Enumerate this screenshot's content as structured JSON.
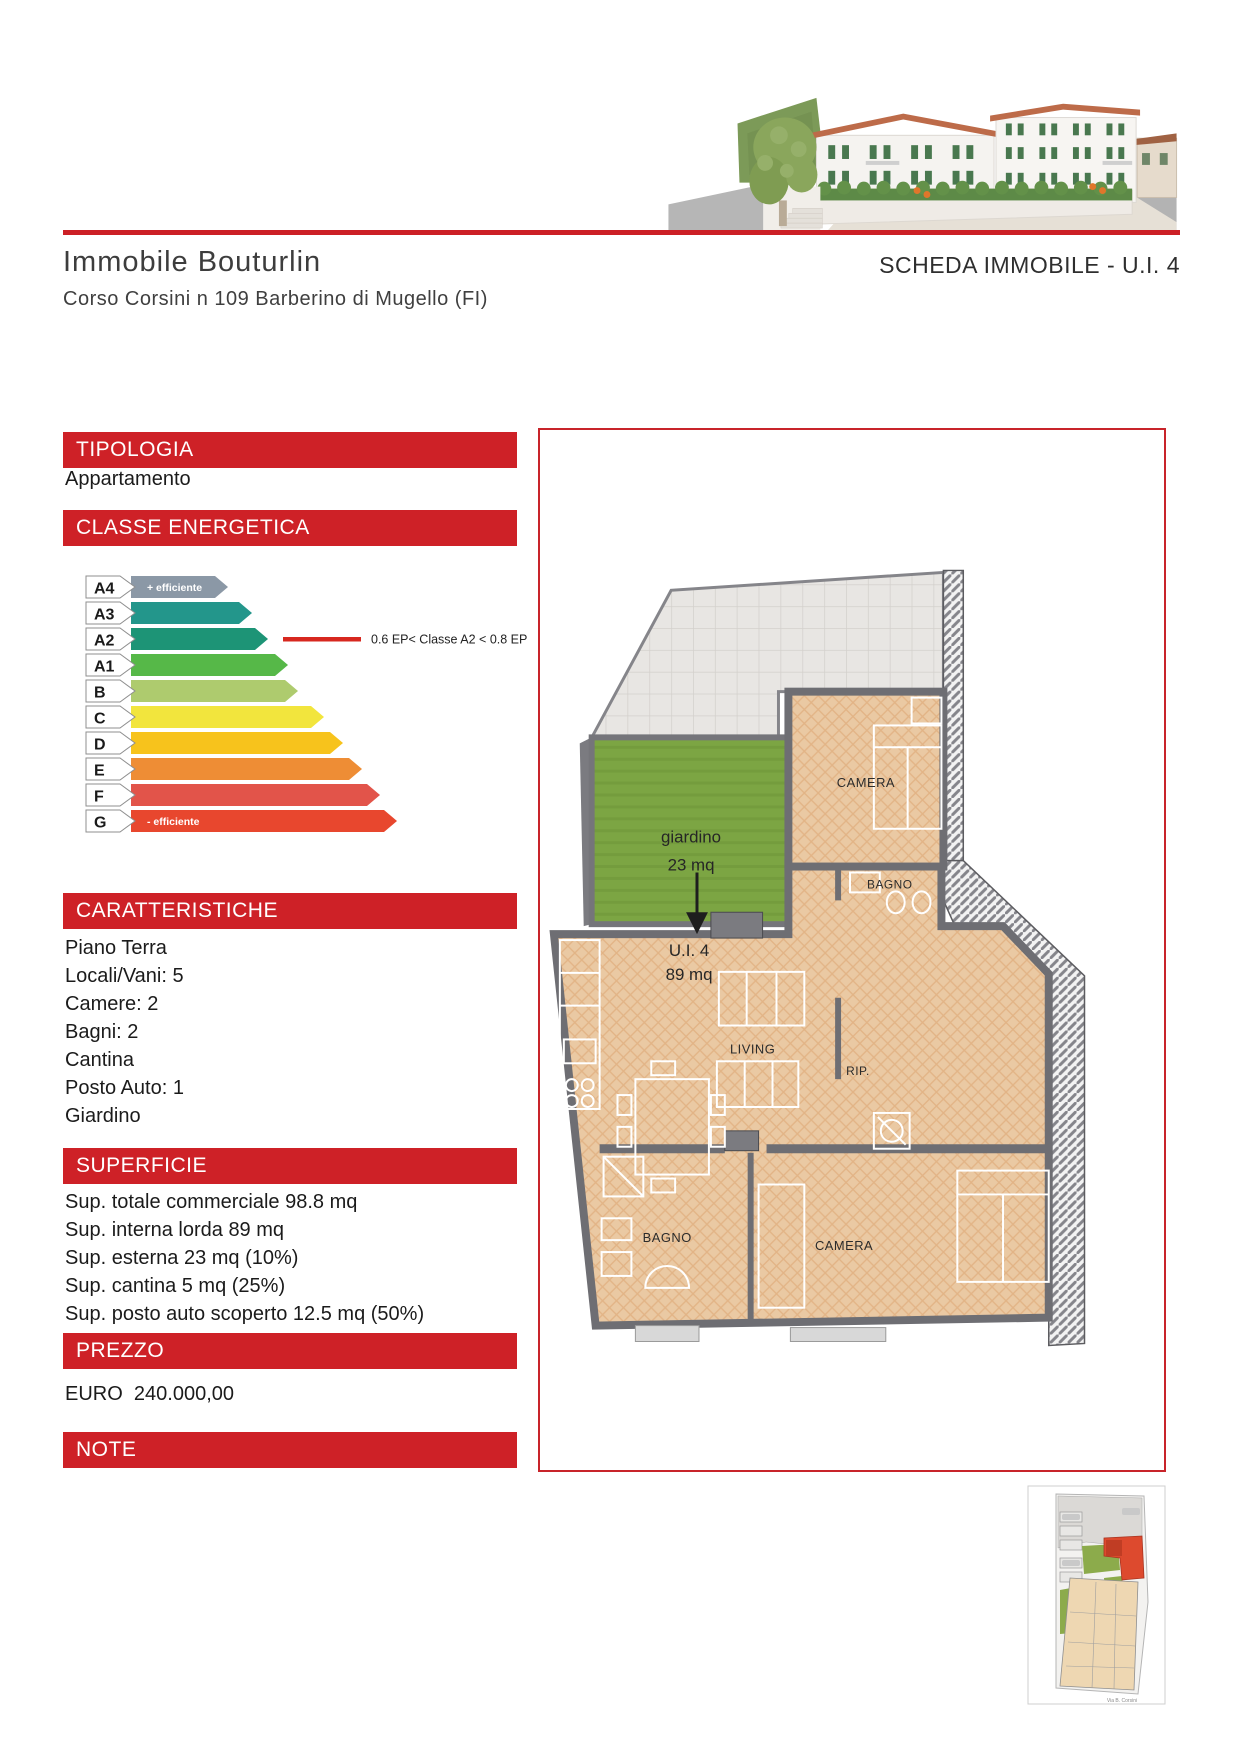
{
  "header": {
    "property_title": "Immobile Bouturlin",
    "property_address": "Corso Corsini n 109 Barberino di Mugello (FI)",
    "sheet_title": "SCHEDA IMMOBILE - U.I. 4"
  },
  "colors": {
    "accent_red": "#ce2127",
    "rule_red": "#cc2026",
    "annotation_red": "#d7281f"
  },
  "sections": {
    "tipologia": {
      "header": "TIPOLOGIA",
      "value": "Appartamento"
    },
    "classe_energetica": {
      "header": "CLASSE ENERGETICA"
    },
    "caratteristiche": {
      "header": "CARATTERISTICHE",
      "items": [
        "Piano Terra",
        "Locali/Vani: 5",
        "Camere: 2",
        "Bagni: 2",
        "Cantina",
        "Posto Auto: 1",
        "Giardino"
      ]
    },
    "superficie": {
      "header": "SUPERFICIE",
      "items": [
        "Sup. totale commerciale 98.8 mq",
        "Sup. interna lorda 89 mq",
        "Sup. esterna 23 mq (10%)",
        "Sup. cantina 5 mq (25%)",
        "Sup. posto auto scoperto 12.5 mq (50%)"
      ]
    },
    "prezzo": {
      "header": "PREZZO",
      "value": "EURO  240.000,00"
    },
    "note": {
      "header": "NOTE"
    }
  },
  "energy_scale": {
    "rows": [
      {
        "label": "A4",
        "color": "#8b98a6",
        "len": 97,
        "tag": "+ efficiente"
      },
      {
        "label": "A3",
        "color": "#23968b",
        "len": 121,
        "tag": ""
      },
      {
        "label": "A2",
        "color": "#1d9476",
        "len": 137,
        "tag": ""
      },
      {
        "label": "A1",
        "color": "#56b848",
        "len": 157,
        "tag": ""
      },
      {
        "label": "B",
        "color": "#aecb6e",
        "len": 167,
        "tag": ""
      },
      {
        "label": "C",
        "color": "#f2e53d",
        "len": 193,
        "tag": ""
      },
      {
        "label": "D",
        "color": "#f7c31c",
        "len": 212,
        "tag": ""
      },
      {
        "label": "E",
        "color": "#ee8d35",
        "len": 231,
        "tag": ""
      },
      {
        "label": "F",
        "color": "#e2544a",
        "len": 249,
        "tag": ""
      },
      {
        "label": "G",
        "color": "#e8472e",
        "len": 266,
        "tag": "- efficiente"
      }
    ],
    "annotation": "0.6 EP< Classe A2 < 0.8 EP",
    "annotation_row": "A2"
  },
  "floorplan": {
    "garden_label": "giardino",
    "garden_area": "23 mq",
    "unit_label": "U.I. 4",
    "unit_area": "89 mq",
    "room_camera_top": "CAMERA",
    "room_bagno_top": "BAGNO",
    "room_living": "LIVING",
    "room_rip": "RIP.",
    "room_bagno_bottom": "BAGNO",
    "room_camera_bottom": "CAMERA"
  },
  "siteplan": {
    "street_label": "Via B. Corsini"
  }
}
